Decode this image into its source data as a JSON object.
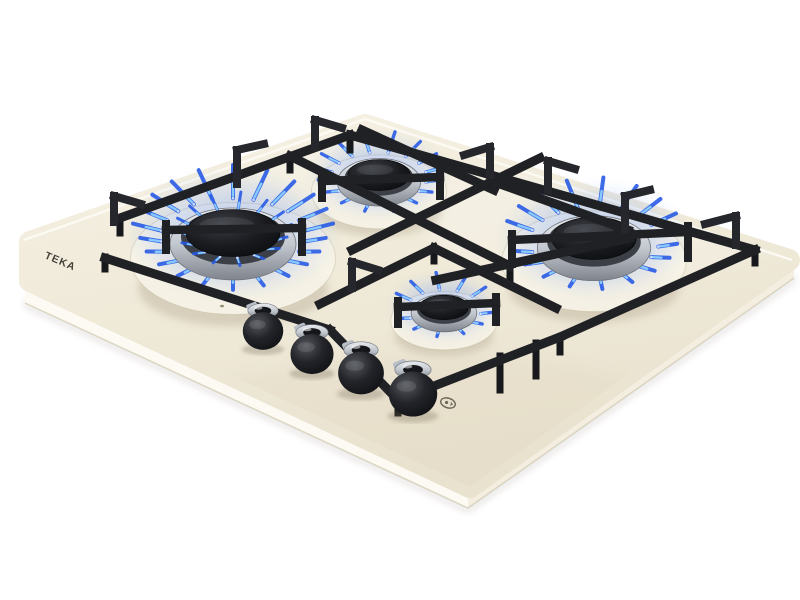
{
  "meta": {
    "image_type": "product photograph",
    "subject": "built-in 4-burner gas hob with lit blue flames, cream glass surface, black cast-iron pan supports, four front control knobs"
  },
  "brand": {
    "logo_text": "TEKA",
    "logo_color": "#45423a"
  },
  "icons": [
    {
      "name": "ignition-spark-icon",
      "description": "small oval ignition symbol printed on glass near front knobs"
    }
  ],
  "palette": {
    "background": "#ffffff",
    "glass_back": "#f6f1e3",
    "glass_mid": "#efe9d8",
    "glass_front": "#e9e2cf",
    "bevel_bright": "#fcfaf3",
    "bevel_right": "#f3eee0",
    "edge_line": "#d8d1bd",
    "grate": "#202125",
    "flame_deep": "#2458e6",
    "flame_mid": "#3b82f6",
    "flame_light": "#8ed0ff",
    "flame_core": "#e9f6ff",
    "steel_light": "#d7dadf",
    "steel_dark": "#878c95",
    "knob_black": "#101114"
  },
  "scene": {
    "canvas": {
      "w": 800,
      "h": 600
    },
    "hob": {
      "top_face_points": [
        [
          30,
          242
        ],
        [
          365,
          125
        ],
        [
          789,
          260
        ],
        [
          470,
          487
        ],
        [
          30,
          281
        ]
      ],
      "bevel_front_left": [
        [
          25,
          287
        ],
        [
          468,
          492
        ],
        [
          468,
          508
        ],
        [
          25,
          303
        ]
      ],
      "bevel_front_right": [
        [
          468,
          492
        ],
        [
          794,
          264
        ],
        [
          794,
          278
        ],
        [
          468,
          508
        ]
      ],
      "bottom_line": [
        [
          25,
          303
        ],
        [
          468,
          508
        ],
        [
          794,
          278
        ]
      ],
      "back_highlight": [
        [
          24,
          240
        ],
        [
          365,
          119
        ],
        [
          792,
          260
        ]
      ]
    },
    "grate": {
      "rails": [
        [
          120,
          218,
          350,
          135
        ],
        [
          350,
          135,
          755,
          250
        ],
        [
          105,
          258,
          330,
          330
        ],
        [
          330,
          330,
          398,
          400
        ],
        [
          398,
          400,
          560,
          337
        ],
        [
          755,
          250,
          560,
          337
        ],
        [
          290,
          156,
          510,
          266
        ],
        [
          352,
          250,
          540,
          158
        ],
        [
          362,
          130,
          494,
          190
        ],
        [
          320,
          304,
          434,
          248
        ],
        [
          434,
          248,
          556,
          308
        ],
        [
          500,
          184,
          628,
          230
        ],
        [
          436,
          280,
          630,
          238
        ]
      ],
      "fingers": [
        [
          166,
          230,
          302,
          228
        ],
        [
          322,
          181,
          440,
          177
        ],
        [
          512,
          240,
          688,
          232
        ],
        [
          398,
          307,
          496,
          303
        ]
      ],
      "stubs": [
        [
          166,
          224,
          166,
          250
        ],
        [
          302,
          222,
          302,
          252
        ],
        [
          322,
          175,
          322,
          198
        ],
        [
          440,
          171,
          440,
          196
        ],
        [
          512,
          234,
          512,
          264
        ],
        [
          688,
          226,
          688,
          258
        ],
        [
          398,
          301,
          398,
          324
        ],
        [
          496,
          297,
          496,
          322
        ]
      ],
      "hooks": [
        {
          "riser": [
            114,
            222,
            114,
            196
          ],
          "cap": [
            114,
            196,
            141,
            204
          ]
        },
        {
          "riser": [
            237,
            184,
            237,
            150
          ],
          "cap": [
            237,
            150,
            264,
            144
          ]
        },
        {
          "riser": [
            315,
            147,
            315,
            120
          ],
          "cap": [
            315,
            120,
            342,
            128
          ]
        },
        {
          "riser": [
            490,
            175,
            490,
            147
          ],
          "cap": [
            490,
            147,
            464,
            155
          ]
        },
        {
          "riser": [
            548,
            190,
            548,
            161
          ],
          "cap": [
            548,
            161,
            575,
            169
          ]
        },
        {
          "riser": [
            736,
            245,
            736,
            216
          ],
          "cap": [
            736,
            216,
            705,
            224
          ]
        },
        {
          "riser": [
            625,
            229,
            625,
            196
          ],
          "cap": [
            625,
            196,
            650,
            190
          ]
        },
        {
          "riser": [
            352,
            288,
            352,
            262
          ],
          "cap": [
            352,
            262,
            378,
            270
          ]
        }
      ],
      "legs": [
        [
          120,
          219,
          120,
          233
        ],
        [
          350,
          136,
          350,
          150
        ],
        [
          755,
          250,
          755,
          263
        ],
        [
          560,
          338,
          560,
          352
        ],
        [
          398,
          400,
          398,
          413
        ],
        [
          105,
          257,
          105,
          269
        ],
        [
          510,
          266,
          510,
          279
        ],
        [
          434,
          249,
          434,
          261
        ],
        [
          500,
          356,
          500,
          390
        ],
        [
          536,
          343,
          536,
          376
        ],
        [
          628,
          230,
          628,
          243
        ],
        [
          290,
          157,
          290,
          170
        ]
      ]
    },
    "burners": [
      {
        "name": "burner-front-left-large",
        "x": 233,
        "y": 236,
        "size": 50,
        "ticks": 22,
        "double": true
      },
      {
        "name": "burner-back-center",
        "x": 379,
        "y": 177,
        "size": 33,
        "ticks": 16,
        "double": false
      },
      {
        "name": "burner-right-large",
        "x": 594,
        "y": 241,
        "size": 45,
        "ticks": 19,
        "double": false
      },
      {
        "name": "burner-front-center-small",
        "x": 444,
        "y": 309,
        "size": 26,
        "ticks": 13,
        "double": false
      }
    ],
    "knobs": [
      {
        "x": 263,
        "y": 331,
        "s": 0.92
      },
      {
        "x": 312,
        "y": 354,
        "s": 0.98
      },
      {
        "x": 361,
        "y": 373,
        "s": 1.04
      },
      {
        "x": 413,
        "y": 394,
        "s": 1.1
      }
    ],
    "logo": {
      "x": 44,
      "y": 258,
      "rotate": 23
    },
    "ignition": {
      "x": 448,
      "y": 403,
      "rotate": 18
    },
    "dots": [
      [
        222,
        306
      ],
      [
        272,
        330
      ],
      [
        322,
        352
      ],
      [
        374,
        376
      ]
    ]
  }
}
